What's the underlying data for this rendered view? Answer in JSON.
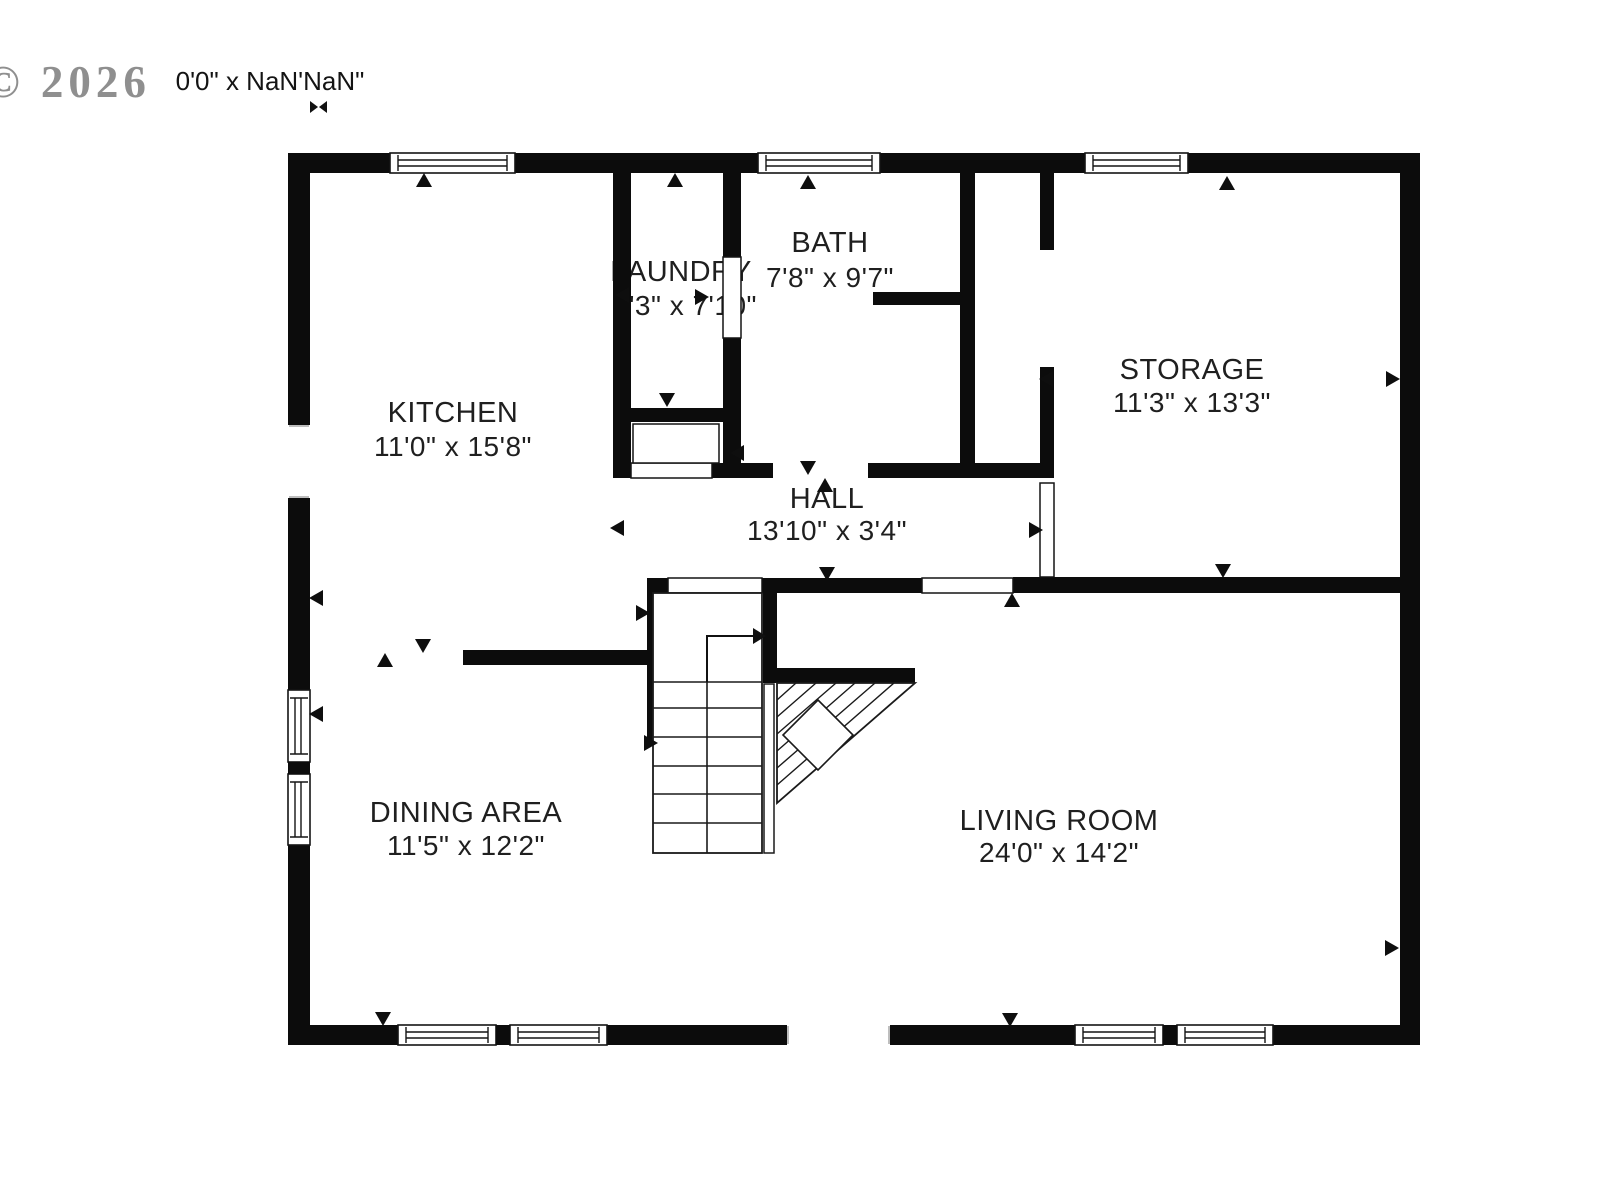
{
  "watermark": {
    "text": "© 2026"
  },
  "scale_note": {
    "text": "0'0\" x NaN'NaN\""
  },
  "icons": {
    "bowtie": "resize-dimension-icon"
  },
  "colors": {
    "wall": "#0c0c0c",
    "text": "#1f1f1f",
    "watermark": "#8f8f8f",
    "frame": "#141414",
    "jamb": "#a8a8a8"
  },
  "plan": {
    "rooms": [
      {
        "name": "KITCHEN",
        "dims": "11'0\" x 15'8\"",
        "cx": 453,
        "name_y": 422,
        "dims_y": 456
      },
      {
        "name": "LAUNDRY",
        "dims": "7'3\" x 7'10\"",
        "cx": 681,
        "name_y": 281,
        "dims_y": 315,
        "dims_cx": 685
      },
      {
        "name": "BATH",
        "dims": "7'8\" x 9'7\"",
        "cx": 830,
        "name_y": 252,
        "dims_y": 287
      },
      {
        "name": "STORAGE",
        "dims": "11'3\" x 13'3\"",
        "cx": 1192,
        "name_y": 379,
        "dims_y": 412
      },
      {
        "name": "HALL",
        "dims": "13'10\" x 3'4\"",
        "cx": 827,
        "name_y": 508,
        "dims_y": 540
      },
      {
        "name": "DINING AREA",
        "dims": "11'5\" x 12'2\"",
        "cx": 466,
        "name_y": 822,
        "dims_y": 855
      },
      {
        "name": "LIVING ROOM",
        "dims": "24'0\" x 14'2\"",
        "cx": 1059,
        "name_y": 830,
        "dims_y": 862
      }
    ],
    "walls_outer": [
      [
        288,
        153,
        102,
        20
      ],
      [
        515,
        153,
        243,
        20
      ],
      [
        880,
        153,
        205,
        20
      ],
      [
        1188,
        153,
        232,
        20
      ],
      [
        288,
        1025,
        110,
        20
      ],
      [
        607,
        1025,
        180,
        20
      ],
      [
        890,
        1025,
        185,
        20
      ],
      [
        1273,
        1025,
        147,
        20
      ],
      [
        288,
        173,
        22,
        252
      ],
      [
        288,
        498,
        22,
        192
      ],
      [
        288,
        845,
        22,
        180
      ],
      [
        1400,
        173,
        20,
        852
      ]
    ],
    "walls_inner": [
      [
        613,
        173,
        18,
        305
      ],
      [
        723,
        173,
        18,
        84
      ],
      [
        723,
        338,
        18,
        140
      ],
      [
        960,
        173,
        15,
        305
      ],
      [
        1040,
        173,
        14,
        77
      ],
      [
        1040,
        367,
        14,
        111
      ],
      [
        631,
        408,
        92,
        14
      ],
      [
        873,
        292,
        87,
        13
      ],
      [
        712,
        463,
        61,
        15
      ],
      [
        868,
        463,
        186,
        15
      ],
      [
        647,
        578,
        21,
        15
      ],
      [
        762,
        578,
        160,
        15
      ],
      [
        1013,
        577,
        387,
        16
      ],
      [
        463,
        650,
        190,
        15
      ],
      [
        647,
        593,
        8,
        147
      ],
      [
        763,
        593,
        14,
        85
      ],
      [
        763,
        668,
        152,
        15
      ]
    ],
    "windows_h": [
      [
        390,
        153,
        125,
        20
      ],
      [
        758,
        153,
        122,
        20
      ],
      [
        1085,
        153,
        103,
        20
      ],
      [
        398,
        1025,
        98,
        20
      ],
      [
        510,
        1025,
        97,
        20
      ],
      [
        1075,
        1025,
        88,
        20
      ],
      [
        1177,
        1025,
        96,
        20
      ]
    ],
    "windows_v": [
      [
        288,
        690,
        22,
        72
      ],
      [
        288,
        774,
        22,
        71
      ]
    ],
    "mullions": [
      [
        496,
        1025,
        14,
        20
      ],
      [
        1163,
        1025,
        14,
        20
      ],
      [
        288,
        762,
        22,
        12
      ]
    ],
    "frames": [
      [
        631,
        463,
        81,
        15
      ],
      [
        633,
        424,
        86,
        39
      ],
      [
        668,
        578,
        94,
        15
      ],
      [
        922,
        578,
        91,
        15
      ],
      [
        1040,
        483,
        14,
        94
      ],
      [
        723,
        257,
        18,
        81
      ]
    ],
    "jambs": [
      [
        289,
        426,
        309,
        426
      ],
      [
        289,
        497,
        309,
        497
      ],
      [
        788,
        1026,
        788,
        1044
      ],
      [
        889,
        1026,
        889,
        1044
      ]
    ],
    "stairs": {
      "well": [
        653,
        593,
        109,
        260
      ],
      "tread_ys": [
        682,
        708,
        737,
        766,
        794,
        823
      ],
      "center_x": 707,
      "center_y1": 682,
      "center_y2": 853,
      "arrow": {
        "x": 707,
        "y_from": 682,
        "y_to": 636,
        "x_to": 753,
        "head": [
          [
            753,
            628
          ],
          [
            753,
            644
          ],
          [
            766,
            636
          ]
        ]
      },
      "rail": [
        764,
        684,
        10,
        169
      ],
      "winder": [
        [
          777,
          683
        ],
        [
          915,
          683
        ],
        [
          777,
          803
        ]
      ],
      "hatch": [
        [
          777,
          700,
          796,
          683
        ],
        [
          777,
          717,
          816,
          683
        ],
        [
          777,
          734,
          836,
          683
        ],
        [
          777,
          751,
          855,
          683
        ],
        [
          777,
          768,
          875,
          683
        ],
        [
          777,
          785,
          894,
          683
        ]
      ],
      "square": [
        [
          818,
          700
        ],
        [
          853,
          735
        ],
        [
          818,
          770
        ],
        [
          783,
          735
        ]
      ]
    },
    "markers": [
      {
        "x": 424,
        "y": 180,
        "dir": "up"
      },
      {
        "x": 675,
        "y": 180,
        "dir": "up"
      },
      {
        "x": 808,
        "y": 182,
        "dir": "up"
      },
      {
        "x": 1227,
        "y": 183,
        "dir": "up"
      },
      {
        "x": 825,
        "y": 485,
        "dir": "up"
      },
      {
        "x": 1012,
        "y": 600,
        "dir": "up"
      },
      {
        "x": 385,
        "y": 660,
        "dir": "up"
      },
      {
        "x": 423,
        "y": 646,
        "dir": "down"
      },
      {
        "x": 667,
        "y": 400,
        "dir": "down"
      },
      {
        "x": 808,
        "y": 468,
        "dir": "down"
      },
      {
        "x": 1223,
        "y": 571,
        "dir": "down"
      },
      {
        "x": 827,
        "y": 574,
        "dir": "down"
      },
      {
        "x": 383,
        "y": 1019,
        "dir": "down"
      },
      {
        "x": 1010,
        "y": 1020,
        "dir": "down"
      },
      {
        "x": 622,
        "y": 295,
        "dir": "left"
      },
      {
        "x": 1046,
        "y": 379,
        "dir": "left"
      },
      {
        "x": 617,
        "y": 528,
        "dir": "left"
      },
      {
        "x": 737,
        "y": 453,
        "dir": "left"
      },
      {
        "x": 316,
        "y": 598,
        "dir": "left"
      },
      {
        "x": 316,
        "y": 714,
        "dir": "left"
      },
      {
        "x": 702,
        "y": 297,
        "dir": "right"
      },
      {
        "x": 1393,
        "y": 379,
        "dir": "right"
      },
      {
        "x": 1036,
        "y": 530,
        "dir": "right"
      },
      {
        "x": 643,
        "y": 613,
        "dir": "right"
      },
      {
        "x": 651,
        "y": 743,
        "dir": "right"
      },
      {
        "x": 1392,
        "y": 948,
        "dir": "right"
      }
    ]
  }
}
